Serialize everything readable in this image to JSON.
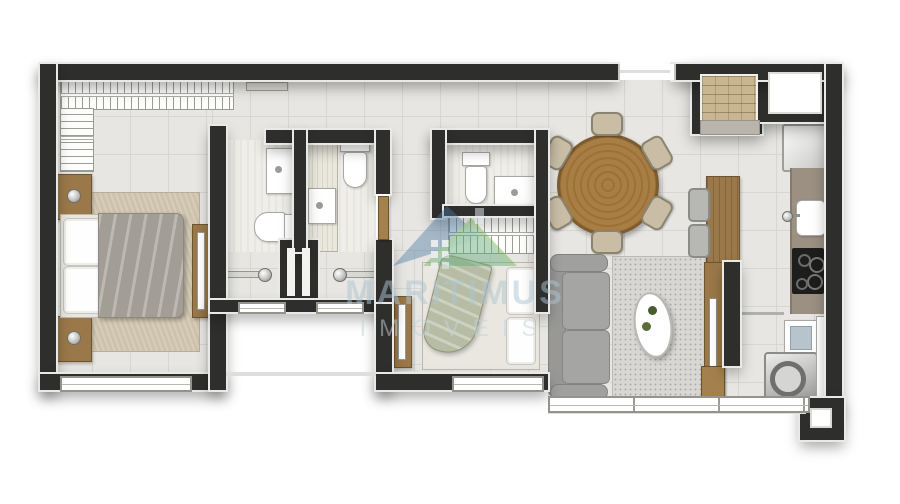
{
  "watermark": {
    "brand": "MARITIMUS",
    "subtitle": "IMÓVEIS",
    "logo": "house-logo-icon"
  },
  "palette": {
    "wall": "#2e2e2c",
    "floor": "#e7e6e2",
    "grid": "#d7d6d2",
    "bathfloor": "#efeee9",
    "wood": "#9a7849",
    "door": "#a5804f",
    "counter": "#9c9083",
    "sofa": "#989896",
    "cushion": "#a5a5a3",
    "rug_bedroom": "#cdc2ab",
    "rug_living": "#d9d7d3",
    "blanket": "#a29d95",
    "throw": "#b7bda5",
    "brick": "#c8b691",
    "cooktop": "#1d1d1b",
    "wm_text": "#aec6d4",
    "wm_sub": "#c2d3dc",
    "wm_roof_left": "#4c7aa4",
    "wm_roof_right": "#5fae4a"
  },
  "rooms": [
    {
      "name": "bedroom-1"
    },
    {
      "name": "bathroom-a"
    },
    {
      "name": "bathroom-b"
    },
    {
      "name": "bathroom-c"
    },
    {
      "name": "hall"
    },
    {
      "name": "bedroom-2"
    },
    {
      "name": "living-dining"
    },
    {
      "name": "kitchen"
    },
    {
      "name": "laundry"
    }
  ],
  "furniture_icons": [
    "wardrobe-hangers-icon",
    "double-bed-icon",
    "nightstand-icon",
    "area-rug-icon",
    "dresser-mirror-icon",
    "washbasin-icon",
    "toilet-icon",
    "shower-vanity-icon",
    "door-knob-icon",
    "duct-shaft-icon",
    "single-bed-icon",
    "round-dining-table-icon",
    "dining-chair-icon",
    "sofa-icon",
    "coffee-table-icon",
    "plant-icon",
    "tv-rack-icon",
    "bar-counter-icon",
    "bar-stool-icon",
    "bbq-brick-niche-icon",
    "refrigerator-icon",
    "kitchen-sink-icon",
    "cooktop-4-burner-icon",
    "laundry-tank-icon",
    "washing-machine-icon",
    "window-icon",
    "sliding-window-icon",
    "door-leaf-icon",
    "pillar-icon"
  ]
}
